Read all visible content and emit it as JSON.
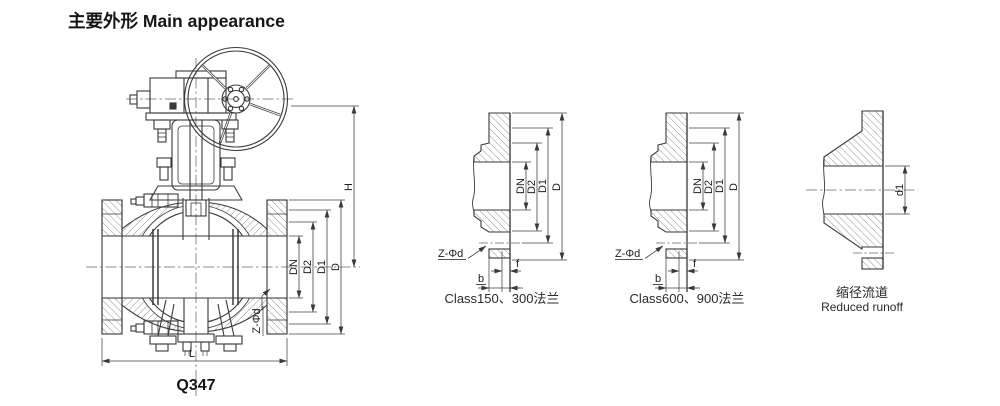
{
  "title": "主要外形 Main appearance",
  "valve": {
    "model": "Q347",
    "dim_h": "H",
    "dim_d": "D",
    "dim_d1": "D1",
    "dim_d2": "D2",
    "dim_dn": "DN",
    "dim_l": "L",
    "bolt_note": "Z-Φd"
  },
  "flange_150_300": {
    "caption": "Class150、300法兰",
    "dim_dn": "DN",
    "dim_d2": "D2",
    "dim_d1": "D1",
    "dim_d": "D",
    "dim_f": "f",
    "dim_b": "b",
    "bolt_note": "Z-Φd"
  },
  "flange_600_900": {
    "caption": "Class600、900法兰",
    "dim_dn": "DN",
    "dim_d2": "D2",
    "dim_d1": "D1",
    "dim_d": "D",
    "dim_f": "f",
    "dim_b": "b",
    "bolt_note": "Z-Φd"
  },
  "reduced_bore": {
    "caption_cn": "缩径流道",
    "caption_en": "Reduced runoff",
    "dim_d1": "d1"
  },
  "colors": {
    "line": "#3a3a3a",
    "dim": "#454545",
    "center": "#666666"
  }
}
